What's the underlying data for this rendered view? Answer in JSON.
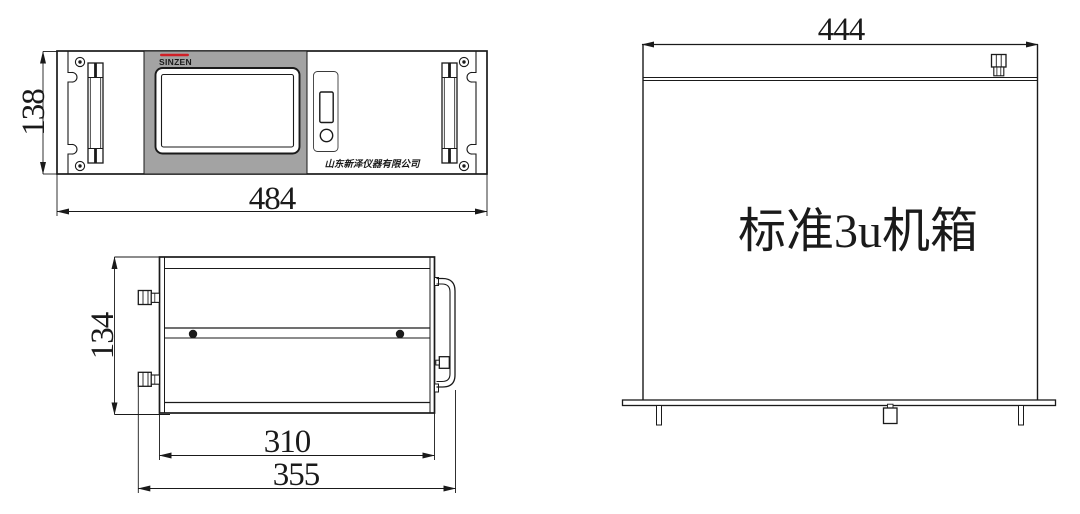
{
  "front_view": {
    "brand": "SINZEN",
    "company": "山东新泽仪器有限公司",
    "height_dim": "138",
    "width_dim": "484"
  },
  "side_view": {
    "height_dim": "134",
    "body_width_dim": "310",
    "overall_width_dim": "355"
  },
  "rear_view": {
    "width_dim": "444",
    "label": "标准3u机箱"
  },
  "colors": {
    "line": "#1a1a1a",
    "panel_gray": "#a3a3a3",
    "brand_red": "#d01f27",
    "background": "#ffffff"
  }
}
